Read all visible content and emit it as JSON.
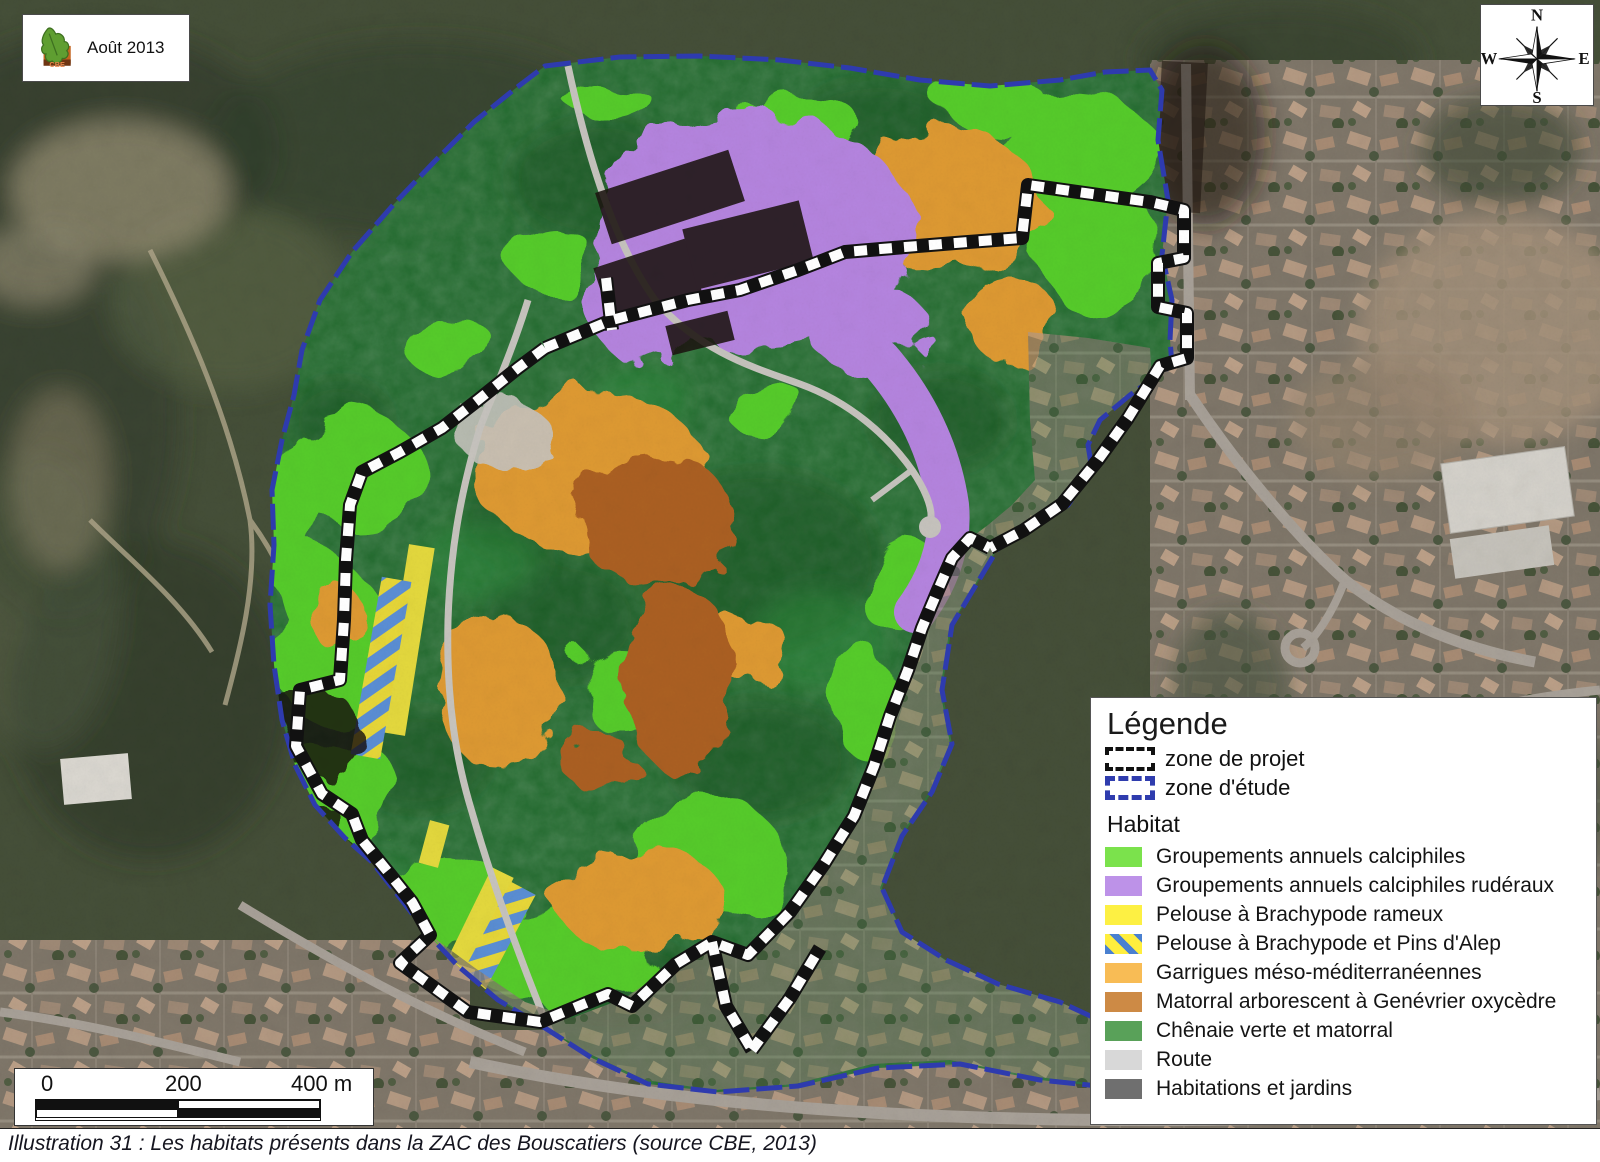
{
  "header": {
    "date_label": "Août 2013",
    "logo_text": "CBE"
  },
  "compass": {
    "n": "N",
    "e": "E",
    "s": "S",
    "w": "W"
  },
  "scale_bar": {
    "tick_0": "0",
    "tick_200": "200",
    "tick_400": "400 m"
  },
  "legend": {
    "title": "Légende",
    "zones": [
      {
        "label": "zone de projet",
        "line_style": "black dashed"
      },
      {
        "label": "zone d'étude",
        "line_style": "blue dashed",
        "color": "#2f3cae"
      }
    ],
    "habitat": {
      "title": "Habitat",
      "items": [
        {
          "label": "Groupements annuels calciphiles",
          "color": "#7be24c"
        },
        {
          "label": "Groupements annuels calciphiles rudéraux",
          "color": "#bd92e8"
        },
        {
          "label": "Pelouse à Brachypode rameux",
          "color": "#fdf043"
        },
        {
          "label": "Pelouse à Brachypode et Pins d'Alep",
          "color": "#ffee3d hatched #4a80d0"
        },
        {
          "label": "Garrigues méso-méditerranéennes",
          "color": "#f8bc55"
        },
        {
          "label": "Matorral arborescent à Genévrier oxycèdre",
          "color": "#cd8a45"
        },
        {
          "label": "Chênaie verte et matorral",
          "color": "#59a159"
        },
        {
          "label": "Route",
          "color": "#d8d8d8"
        },
        {
          "label": "Habitations et jardins",
          "color": "#6f6f6f"
        }
      ]
    }
  },
  "map": {
    "overlay_colors": {
      "calciphiles": "#57cd2b",
      "ruderaux": "#b685e0",
      "pelouse": "#e5da3d",
      "pins_hatch_blue": "#5b8fd6",
      "garrigues": "#df9a31",
      "matorral": "#ac6120",
      "chenaie": "#1f6a2c",
      "route": "#c8c5bf",
      "habitations": "#150d09"
    },
    "boundary_colors": {
      "zone_d_etude": "#2e3bb0",
      "zone_de_projet": "white on black"
    }
  },
  "caption": {
    "text": "Illustration 31 : Les habitats présents dans la ZAC des Bouscatiers (source CBE, 2013)"
  }
}
